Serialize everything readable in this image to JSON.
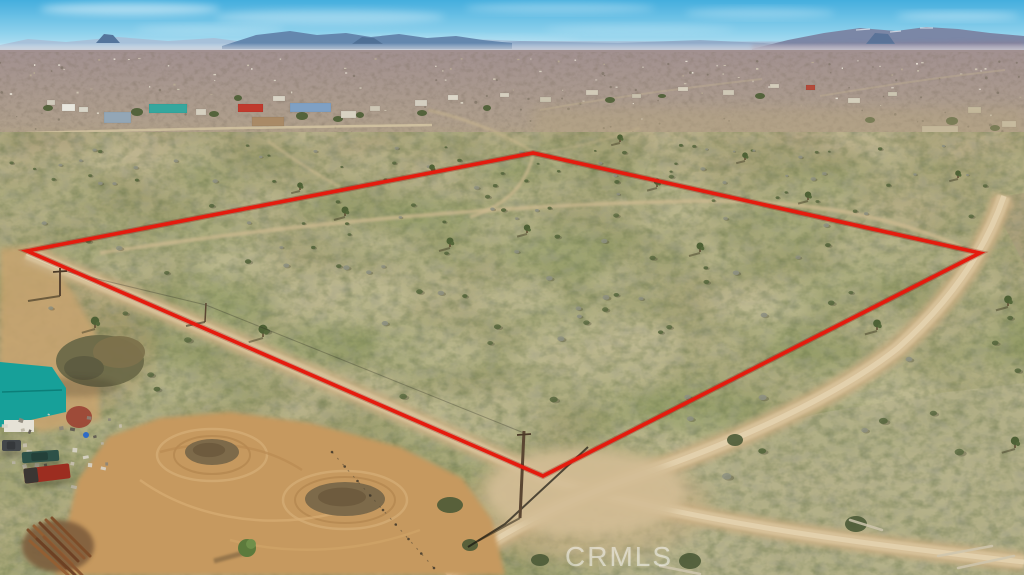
{
  "meta": {
    "description": "Aerial drone photograph of a vacant high-desert land parcel outlined with a red property boundary, at a dirt road intersection, with scattered rural homes, a teal-roofed homestead, and mountain ranges on the horizon.",
    "width": 1024,
    "height": 575
  },
  "watermark": {
    "text": "CRMLS"
  },
  "boundary": {
    "color": "#e51b0e",
    "underglow": "#8f0b05",
    "stroke_width": 3.6,
    "vertices": [
      [
        27,
        251
      ],
      [
        533,
        153
      ],
      [
        980,
        253
      ],
      [
        543,
        476
      ]
    ]
  },
  "palette": {
    "sky_top": "#44aede",
    "sky_mid": "#8ed1ec",
    "sky_horizon": "#d8eef7",
    "haze": "#d9d6da",
    "plain_top": "#a19090",
    "plain_bottom": "#b2a28a",
    "town_band": "#b3a68b",
    "fg_top": "#b2a584",
    "fg_mid": "#aba67d",
    "fg_bottom": "#a8a377",
    "green_mottle": "#7f9255",
    "pale_mottle": "#d4cba6",
    "bush_dark": "#55663c",
    "bush_gray": "#8d9081",
    "road": "#c9af83",
    "road_mid": "#d8c29a",
    "road_bright": "#e3d2ae",
    "trail": "#cdba90",
    "yard_dirt": "#c6995e",
    "sage": "#b5b18b",
    "shadow": "#3f3d2c"
  },
  "scene": {
    "clouds": [
      [
        130,
        9,
        90,
        6,
        0.5
      ],
      [
        330,
        17,
        115,
        7,
        0.33
      ],
      [
        560,
        8,
        95,
        5,
        0.3
      ],
      [
        760,
        13,
        75,
        5,
        0.28
      ],
      [
        958,
        16,
        62,
        4,
        0.38
      ],
      [
        210,
        29,
        75,
        4,
        0.25
      ],
      [
        640,
        29,
        95,
        4,
        0.2
      ],
      [
        450,
        40,
        130,
        4,
        0.16
      ],
      [
        900,
        38,
        80,
        3,
        0.2
      ]
    ],
    "mountains": [
      {
        "name": "far-range",
        "d": "M0,45 L28,39 L66,42 L118,37 L168,41 L214,38 L252,43 L296,41 L340,43 L420,42 L470,39 L520,41 L1024,42 L1024,52 L0,52 Z",
        "fill": "#a7c0d8",
        "o": 0.95
      },
      {
        "name": "mid-range",
        "d": "M430,46 L520,41 L618,43 L700,40 L764,43 L790,46 L790,50 L430,50 Z",
        "fill": "#8fa9c6",
        "o": 0.9
      },
      {
        "name": "left-range",
        "d": "M222,46 L256,35 L290,31 L317,35 L346,33 L371,37 L399,34 L427,38 L456,36 L483,40 L512,43 L512,49 L222,49 Z",
        "fill": "#6487ae",
        "o": 1
      },
      {
        "name": "right-massif",
        "d": "M752,49 L788,40 L824,33 L860,28 L896,31 L926,27 L958,29 L990,33 L1024,36 L1024,53 L752,53 Z",
        "fill": "#7b87a6",
        "o": 1
      },
      {
        "name": "right-low-band",
        "d": "M752,45 L1024,41 L1024,54 L752,54 Z",
        "fill": "#8d7f94",
        "o": 0.6,
        "blur": 2
      },
      {
        "name": "butte-left",
        "d": "M96,43 L104,34 L113,35 L120,43 Z",
        "fill": "#54759c",
        "o": 1
      },
      {
        "name": "butte-mid",
        "d": "M352,44 L362,37 L374,38 L383,44 Z",
        "fill": "#4f7096",
        "o": 1
      },
      {
        "name": "butte-right",
        "d": "M866,44 L875,33 L888,34 L895,44 Z",
        "fill": "#5a7398",
        "o": 1
      }
    ],
    "snow_caps": [
      [
        856,
        30,
        870,
        29
      ],
      [
        890,
        32,
        901,
        31
      ],
      [
        920,
        28,
        933,
        28
      ]
    ],
    "tints": [
      {
        "d": "M533,150 L1024,252 L1024,108 L533,108 Z",
        "fill": "#b5a480",
        "o": 0.4
      },
      {
        "d": "M0,254 L27,251 L533,152 L533,132 L0,132 Z",
        "fill": "#b1a17d",
        "o": 0.35
      }
    ],
    "buildings": [
      [
        62,
        104,
        13,
        7,
        "#e9e7de"
      ],
      [
        79,
        107,
        9,
        5,
        "#d9d5c8"
      ],
      [
        47,
        100,
        8,
        5,
        "#cfc9ba"
      ],
      [
        104,
        112,
        27,
        11,
        "#93a6b6"
      ],
      [
        149,
        104,
        38,
        9,
        "#35a79e"
      ],
      [
        196,
        109,
        10,
        6,
        "#d6d0c0"
      ],
      [
        238,
        104,
        25,
        8,
        "#c03a2d"
      ],
      [
        252,
        117,
        32,
        9,
        "#a98a66"
      ],
      [
        290,
        103,
        41,
        9,
        "#7fa0c4"
      ],
      [
        273,
        96,
        12,
        5,
        "#d9d3c5"
      ],
      [
        341,
        111,
        15,
        7,
        "#d8d2c2"
      ],
      [
        370,
        106,
        10,
        5,
        "#cdc6b4"
      ],
      [
        415,
        100,
        12,
        6,
        "#d4cec0"
      ],
      [
        448,
        95,
        10,
        5,
        "#ddd7c9"
      ],
      [
        500,
        93,
        9,
        4,
        "#d6cfbf"
      ],
      [
        540,
        97,
        11,
        5,
        "#cbc4b0"
      ],
      [
        586,
        90,
        12,
        5,
        "#d2cab8"
      ],
      [
        632,
        94,
        9,
        4,
        "#c9c1ad"
      ],
      [
        678,
        87,
        10,
        4,
        "#d7d0be"
      ],
      [
        723,
        90,
        11,
        5,
        "#cfc8b6"
      ],
      [
        770,
        84,
        9,
        4,
        "#d3ccba"
      ],
      [
        806,
        85,
        9,
        5,
        "#b44a3a"
      ],
      [
        848,
        98,
        12,
        5,
        "#d6d0be"
      ],
      [
        888,
        92,
        9,
        4,
        "#ccc5b1"
      ],
      [
        922,
        126,
        36,
        8,
        "#cfc5ab"
      ],
      [
        826,
        133,
        28,
        7,
        "#e0dbcd"
      ],
      [
        968,
        107,
        13,
        6,
        "#c9bfa4"
      ],
      [
        1002,
        121,
        14,
        6,
        "#d2c9b2"
      ]
    ],
    "town_trees": [
      [
        137,
        112,
        6,
        4
      ],
      [
        214,
        114,
        5,
        3
      ],
      [
        302,
        116,
        6,
        4
      ],
      [
        338,
        119,
        5,
        3
      ],
      [
        360,
        115,
        4,
        3
      ],
      [
        422,
        113,
        5,
        3
      ],
      [
        487,
        108,
        4,
        3
      ],
      [
        610,
        100,
        5,
        3
      ],
      [
        662,
        96,
        4,
        2
      ],
      [
        760,
        96,
        5,
        3
      ],
      [
        952,
        121,
        6,
        4
      ],
      [
        995,
        128,
        5,
        3
      ],
      [
        870,
        120,
        5,
        3
      ],
      [
        48,
        108,
        5,
        3
      ],
      [
        238,
        98,
        4,
        3
      ]
    ],
    "town_road": "M0,134 C150,129 300,127 432,125",
    "far_roads": [
      "M540,110 C620,96 700,86 762,79",
      "M820,96 C880,86 950,76 1005,70"
    ],
    "roads": {
      "road_b": "M27,253 C180,318 390,406 543,478 C690,523 880,546 1024,562",
      "road_a": "M1004,196 C986,248 952,300 898,348 C838,396 735,442 648,472 C562,501 492,535 447,575",
      "junction": [
        585,
        492,
        100,
        44
      ],
      "left_patch": "M0,248 L45,246 L95,330 L100,420 L40,432 L0,402 Z"
    },
    "trails": [
      {
        "d": "M100,253 C300,222 520,204 700,201 C800,200 884,213 962,247",
        "w": 4,
        "o": 0.75
      },
      {
        "d": "M533,156 C525,186 505,206 470,217",
        "w": 3.5,
        "o": 0.7
      },
      {
        "d": "M533,152 C504,134 468,119 428,110",
        "w": 3,
        "o": 0.5
      },
      {
        "d": "M268,141 C290,157 312,172 340,187",
        "w": 3,
        "o": 0.5
      },
      {
        "d": "M640,128 C610,140 570,148 540,153",
        "w": 2.5,
        "o": 0.4
      }
    ],
    "patches_pale": [
      [
        340,
        300,
        70,
        30
      ],
      [
        600,
        350,
        85,
        35
      ],
      [
        760,
        300,
        55,
        22
      ],
      [
        470,
        420,
        70,
        26
      ],
      [
        240,
        265,
        45,
        18
      ],
      [
        680,
        440,
        80,
        28
      ],
      [
        880,
        390,
        60,
        24
      ],
      [
        430,
        350,
        60,
        22
      ],
      [
        910,
        480,
        70,
        26
      ],
      [
        700,
        540,
        80,
        26
      ],
      [
        520,
        300,
        50,
        20
      ]
    ],
    "patches_green": [
      [
        320,
        345,
        55,
        22
      ],
      [
        560,
        255,
        60,
        22
      ],
      [
        700,
        410,
        65,
        24
      ],
      [
        430,
        215,
        50,
        16
      ],
      [
        610,
        470,
        70,
        24
      ],
      [
        820,
        350,
        50,
        20
      ],
      [
        240,
        310,
        40,
        16
      ],
      [
        500,
        500,
        60,
        20
      ],
      [
        860,
        440,
        55,
        20
      ]
    ],
    "sage_region": "M600,575 L588,496 L700,446 L820,413 L940,393 L1024,383 L1024,575 Z",
    "ne_corner": "M990,199 L1024,193 L1024,264 Z",
    "joshua_trees": [
      [
        95,
        328,
        1.2
      ],
      [
        263,
        337,
        1.3
      ],
      [
        345,
        216,
        1
      ],
      [
        450,
        247,
        1
      ],
      [
        527,
        233,
        0.9
      ],
      [
        657,
        187,
        0.9
      ],
      [
        700,
        252,
        1
      ],
      [
        808,
        200,
        0.9
      ],
      [
        877,
        330,
        1.1
      ],
      [
        1008,
        306,
        1.1
      ],
      [
        620,
        142,
        0.8
      ],
      [
        432,
        172,
        0.8
      ],
      [
        300,
        190,
        0.8
      ],
      [
        745,
        160,
        0.8
      ],
      [
        958,
        178,
        0.8
      ],
      [
        1015,
        448,
        1.2
      ]
    ],
    "big_bushes": [
      [
        856,
        524,
        11,
        8
      ],
      [
        735,
        440,
        8,
        6
      ],
      [
        690,
        561,
        11,
        8
      ],
      [
        450,
        505,
        13,
        8
      ],
      [
        470,
        545,
        8,
        6
      ],
      [
        540,
        560,
        9,
        6
      ]
    ],
    "debris": [
      [
        938,
        556,
        992,
        546
      ],
      [
        958,
        568,
        1014,
        556
      ],
      [
        850,
        520,
        882,
        530
      ],
      [
        660,
        566,
        700,
        574
      ]
    ],
    "yard": {
      "outline": "M55,575 L78,480 L108,437 L160,418 L230,412 L310,423 L400,447 L462,478 L492,520 L505,575 Z",
      "mounds": [
        [
          212,
          452,
          27,
          13
        ],
        [
          345,
          499,
          40,
          17
        ]
      ],
      "rings": [
        [
          212,
          455,
          55,
          26
        ],
        [
          345,
          500,
          62,
          29
        ],
        [
          212,
          455,
          38,
          19
        ],
        [
          345,
          500,
          50,
          23
        ]
      ],
      "swirls": [
        "M140,480 C190,516 262,530 332,514",
        "M160,452 C212,438 262,444 302,470",
        "M230,540 C290,556 360,552 420,530"
      ]
    },
    "fence": {
      "from": [
        332,
        452
      ],
      "to": [
        434,
        568
      ],
      "posts": 9
    },
    "homestead": {
      "roof": "M0,362 L52,367 L66,388 L66,412 L0,427 Z",
      "roof_fill": "#17a099",
      "ridge": "M2,392 L62,390",
      "wall": [
        4,
        420,
        30,
        12
      ],
      "wall_fill": "#e6e2d6",
      "big_tree": [
        [
          100,
          361,
          44,
          26,
          "#6c6948"
        ],
        [
          119,
          352,
          26,
          16,
          "#7d724c"
        ],
        [
          84,
          368,
          20,
          12,
          "#5d5c40"
        ]
      ],
      "red_bush": [
        79,
        417,
        13,
        11,
        "#9c4736"
      ],
      "barrel": [
        86,
        435,
        3,
        "#2e6bc6"
      ]
    },
    "small_tree": {
      "cx": 247,
      "cy": 548,
      "r": 9,
      "shadow": "M247,552 L214,561"
    },
    "pipes": {
      "soil": [
        58,
        546,
        36,
        26
      ],
      "bars": [
        [
          28,
          530,
          66,
          568
        ],
        [
          34,
          526,
          72,
          564
        ],
        [
          40,
          523,
          78,
          561
        ],
        [
          46,
          520,
          84,
          558
        ],
        [
          52,
          518,
          90,
          556
        ],
        [
          30,
          541,
          68,
          575
        ],
        [
          37,
          539,
          75,
          575
        ],
        [
          44,
          537,
          82,
          575
        ]
      ],
      "colors": [
        "#7d4b27",
        "#955f33",
        "#6d4023",
        "#8a5630"
      ]
    },
    "vehicles": {
      "truck": {
        "x": 24,
        "y": 466,
        "w": 46,
        "h": 15,
        "rot": -7,
        "body": "#9c2d20",
        "cab": "#3a3633"
      },
      "car": {
        "x": 22,
        "y": 451,
        "w": 37,
        "h": 11,
        "rot": -4,
        "body": "#2d5148"
      },
      "suv": {
        "x": 2,
        "y": 440,
        "w": 19,
        "h": 11,
        "rot": 0,
        "body": "#43474a"
      }
    },
    "poles": [
      {
        "base": [
          60,
          296
        ],
        "top": [
          60,
          268
        ],
        "w": 2,
        "cross": true,
        "shadow": [
          28,
          301
        ]
      },
      {
        "base": [
          205,
          322
        ],
        "top": [
          206,
          303
        ],
        "w": 1.5,
        "cross": false,
        "shadow": [
          186,
          326
        ]
      },
      {
        "base": [
          520,
          518
        ],
        "top": [
          524,
          431
        ],
        "w": 3,
        "cross": true,
        "shadow": [
          478,
          541
        ]
      }
    ],
    "wires": [
      {
        "pts": "60,270 206,305 524,433",
        "o": 0.3,
        "w": 1,
        "dark": false
      },
      {
        "pts": "588,447 505,524 468,547",
        "o": 0.7,
        "w": 2,
        "dark": true
      }
    ]
  }
}
